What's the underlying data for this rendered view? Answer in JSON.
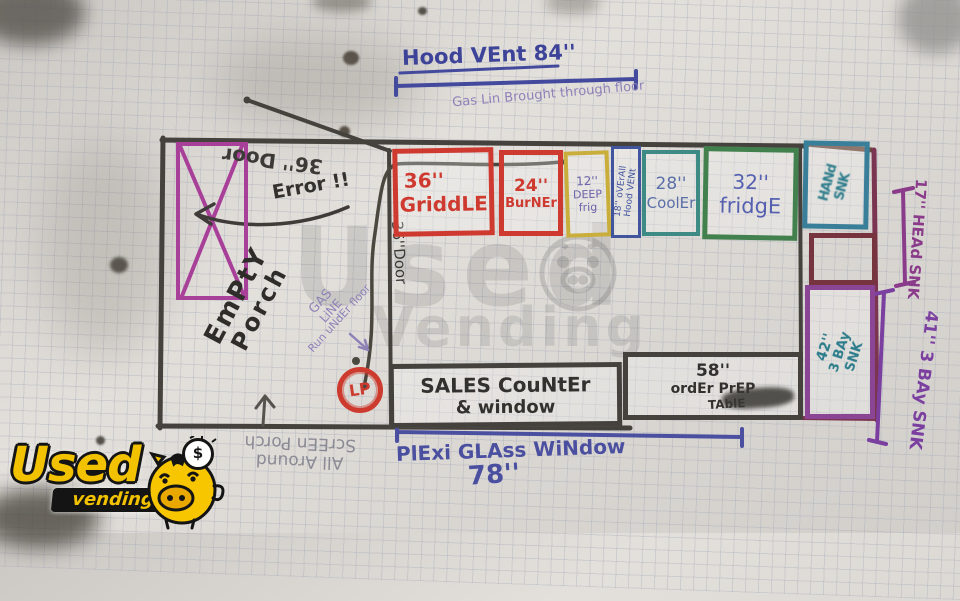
{
  "page": {
    "description": "Hand-drawn concession trailer floor plan on grid paper"
  },
  "colors": {
    "marker_black": "#35332f",
    "marker_red": "#cf3a30",
    "magenta": "#a83f98",
    "yellow": "#c9ae3c",
    "blue": "#41549e",
    "teal": "#3e8b85",
    "green": "#42804d",
    "maroon": "#76343f",
    "purple_box": "#8a4694",
    "ink_blue": "#4b4fa0",
    "ink_violet": "#8d82b8",
    "dim_purple": "#8a3c8a",
    "logo_yellow": "#f2c200"
  },
  "top": {
    "hood_vent": "Hood VEnt  84''",
    "gas_through_floor": "Gas Lin Brought through floor"
  },
  "porch": {
    "door_label": "36'' Door",
    "error": "Error !!",
    "empty_line1": "EmPtY",
    "empty_line2": "Porch",
    "gas_line1": "GAS",
    "gas_line2": "LiNE",
    "gas_line3": "Run uNdEr floor",
    "interior_door": "36''Door",
    "screen_line1": "All Around",
    "screen_line2": "ScrEEn Porch"
  },
  "appliances": {
    "griddle_size": "36''",
    "griddle": "GriddLE",
    "burner_size": "24''",
    "burner": "BurNEr",
    "fryer_size": "12''",
    "fryer_line2": "DEEP",
    "fryer_line3": "frig",
    "vent_strip_line1": "18'' oVErAll",
    "vent_strip_line2": "Hood VENt",
    "cooler_size": "28''",
    "cooler": "CoolEr",
    "fridge_size": "32''",
    "fridge": "fridgE"
  },
  "right_side": {
    "hand_sink_line1": "HANd",
    "hand_sink_line2": "SNK",
    "sink42_line1": "42''",
    "sink42_line2": "3 BAy",
    "sink42_line3": "SNK",
    "head_sink_dim": "17'' HEAd SNK",
    "bay_sink_dim": "41'' 3 BAy SNK"
  },
  "counter": {
    "lp": "LP",
    "sales_line1": "SALES CouNtEr",
    "sales_line2": "& window",
    "pickup_size": "58''",
    "pickup_line2": "ordEr PrEP",
    "pickup_line3": "TAblE",
    "plexi": "PlExi GLAss WiNdow",
    "plexi_size": "78''"
  },
  "watermark": {
    "word1": "Used",
    "word2": "Vending"
  },
  "logo": {
    "word1": "Used",
    "word2": "vending",
    "coin": "$"
  }
}
